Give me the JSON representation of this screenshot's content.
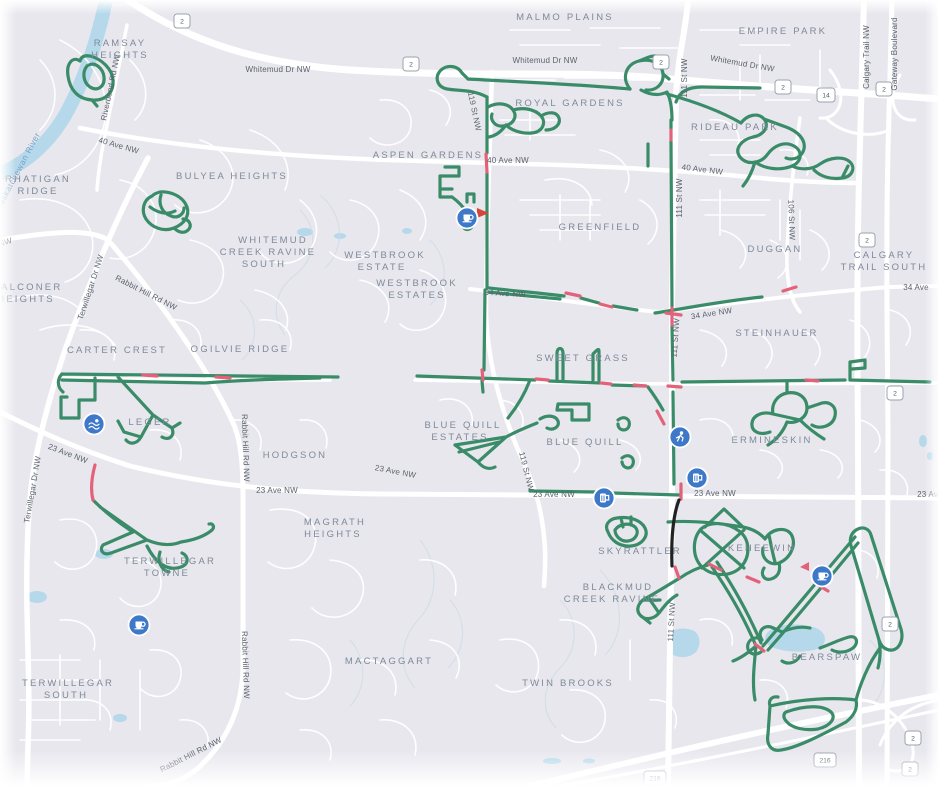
{
  "map": {
    "colors": {
      "background": "#e8e7ee",
      "road": "#ffffff",
      "water": "#b5d8ea",
      "route_green": "#3a8c69",
      "route_flagged_pink": "#e4617a",
      "route_black": "#222222",
      "poi_blue": "#3e78c9",
      "neighborhood_label": "#7e8a99",
      "road_label": "#5a626b"
    },
    "neighborhoods": [
      {
        "lines": [
          "RAMSAY",
          "HEIGHTS"
        ]
      },
      {
        "lines": [
          "MALMO PLAINS"
        ]
      },
      {
        "lines": [
          "EMPIRE PARK"
        ]
      },
      {
        "lines": [
          "ROYAL GARDENS"
        ]
      },
      {
        "lines": [
          "RIDEAU PARK"
        ]
      },
      {
        "lines": [
          "ASPEN GARDENS"
        ]
      },
      {
        "lines": [
          "RHATIGAN",
          "RIDGE"
        ]
      },
      {
        "lines": [
          "BULYEA HEIGHTS"
        ]
      },
      {
        "lines": [
          "WHITEMUD",
          "CREEK RAVINE",
          "SOUTH"
        ]
      },
      {
        "lines": [
          "GREENFIELD"
        ]
      },
      {
        "lines": [
          "DUGGAN"
        ]
      },
      {
        "lines": [
          "CALGARY",
          "TRAIL SOUTH"
        ]
      },
      {
        "lines": [
          "WESTBROOK",
          "ESTATE"
        ]
      },
      {
        "lines": [
          "WESTBROOK",
          "ESTATES"
        ]
      },
      {
        "lines": [
          "FALCONER",
          "HEIGHTS"
        ]
      },
      {
        "lines": [
          "CARTER CREST"
        ]
      },
      {
        "lines": [
          "OGILVIE RIDGE"
        ]
      },
      {
        "lines": [
          "STEINHAUER"
        ]
      },
      {
        "lines": [
          "SWEET GRASS"
        ]
      },
      {
        "lines": [
          "LEGER"
        ]
      },
      {
        "lines": [
          "BLUE QUILL",
          "ESTATES"
        ]
      },
      {
        "lines": [
          "BLUE QUILL"
        ]
      },
      {
        "lines": [
          "ERMINESKIN"
        ]
      },
      {
        "lines": [
          "HODGSON"
        ]
      },
      {
        "lines": [
          "MAGRATH",
          "HEIGHTS"
        ]
      },
      {
        "lines": [
          "TERWILLEGAR",
          "TOWNE"
        ]
      },
      {
        "lines": [
          "SKYRATTLER"
        ]
      },
      {
        "lines": [
          "KEHEEWIN"
        ]
      },
      {
        "lines": [
          "BLACKMUD",
          "CREEK RAVINE"
        ]
      },
      {
        "lines": [
          "BEARSPAW"
        ]
      },
      {
        "lines": [
          "TERWILLEGAR",
          "SOUTH"
        ]
      },
      {
        "lines": [
          "MACTAGGART"
        ]
      },
      {
        "lines": [
          "TWIN BROOKS"
        ]
      }
    ],
    "roads": [
      {
        "label": "Whitemud Dr NW"
      },
      {
        "label": "Whitemud Dr NW"
      },
      {
        "label": "Whitemud Dr NW"
      },
      {
        "label": "Riverbend Rd NW"
      },
      {
        "label": "40 Ave NW"
      },
      {
        "label": "40 Ave NW"
      },
      {
        "label": "40 Ave NW"
      },
      {
        "label": "119 St NW"
      },
      {
        "label": "119 St NW"
      },
      {
        "label": "111 St NW"
      },
      {
        "label": "111 St NW"
      },
      {
        "label": "111 St NW"
      },
      {
        "label": "111 St NW"
      },
      {
        "label": "106 St NW"
      },
      {
        "label": "Calgary Trail NW"
      },
      {
        "label": "Gateway Boulevard"
      },
      {
        "label": "34 Ave NW"
      },
      {
        "label": "34 Ave NW"
      },
      {
        "label": "34 Ave"
      },
      {
        "label": "Rabbit Hill Rd NW"
      },
      {
        "label": "Rabbit Hill Rd NW"
      },
      {
        "label": "Rabbit Hill Rd NW"
      },
      {
        "label": "Rabbit Hill Rd NW"
      },
      {
        "label": "Terwillegar Dr NW"
      },
      {
        "label": "Terwillegar Dr NW"
      },
      {
        "label": "23 Ave NW"
      },
      {
        "label": "23 Ave NW"
      },
      {
        "label": "23 Ave NW"
      },
      {
        "label": "23 Ave NW"
      },
      {
        "label": "23 Ave NW"
      },
      {
        "label": "23 Ave NW"
      },
      {
        "label": "Rabbit Hill Rd NW"
      }
    ],
    "water_label": "North Saskatchewan River",
    "shields": [
      {
        "num": "2"
      },
      {
        "num": "2"
      },
      {
        "num": "2"
      },
      {
        "num": "2"
      },
      {
        "num": "14"
      },
      {
        "num": "2"
      },
      {
        "num": "2"
      },
      {
        "num": "2"
      },
      {
        "num": "2"
      },
      {
        "num": "216"
      },
      {
        "num": "216"
      },
      {
        "num": "2"
      },
      {
        "num": "2"
      }
    ],
    "pois": [
      {
        "name": "cafe",
        "glyph": "cup"
      },
      {
        "name": "swimming",
        "glyph": "swimmer"
      },
      {
        "name": "cyclist",
        "glyph": "person"
      },
      {
        "name": "brewery",
        "glyph": "beer-mug"
      },
      {
        "name": "brewery",
        "glyph": "beer-mug"
      },
      {
        "name": "cafe",
        "glyph": "cup"
      },
      {
        "name": "cafe",
        "glyph": "cup"
      }
    ]
  }
}
